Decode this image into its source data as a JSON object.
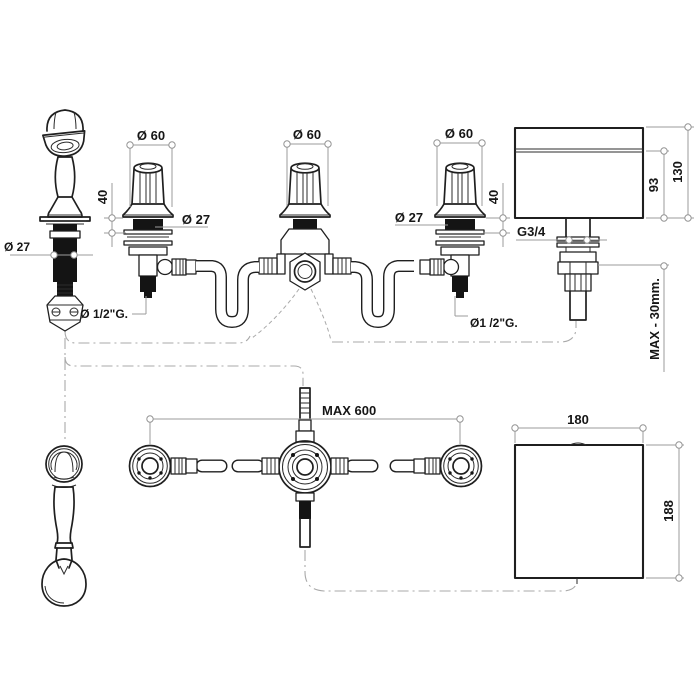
{
  "drawing": {
    "hand_shower": {
      "shaft_diameter": "Ø 27"
    },
    "left_valve": {
      "knob_diameter": "Ø 60",
      "body_height": "40",
      "shaft_diameter": "Ø 27",
      "inlet_thread": "Ø 1/2\"G."
    },
    "diverter": {
      "knob_diameter": "Ø 60"
    },
    "right_valve": {
      "knob_diameter": "Ø 60",
      "body_height": "40",
      "shaft_diameter": "Ø 27",
      "inlet_thread": "Ø1 /2\"G."
    },
    "spout": {
      "tail_thread": "G3/4",
      "body_height": "93",
      "total_height": "130",
      "max_deck_thickness": "MAX - 30mm."
    },
    "plan": {
      "max_valve_spacing": "MAX 600",
      "spout_width": "180",
      "spout_depth": "188"
    },
    "colors": {
      "line": "#1f1f1f",
      "dimension": "#9b9b9b",
      "background": "#ffffff"
    }
  }
}
